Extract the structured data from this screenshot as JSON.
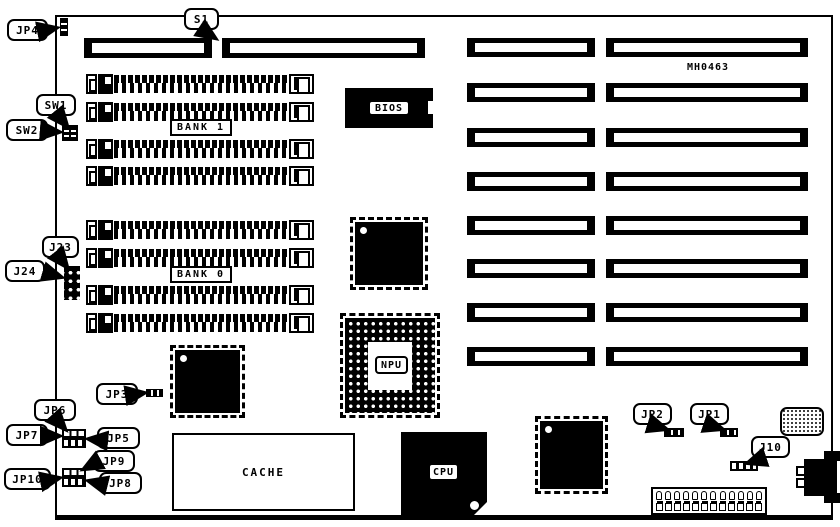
{
  "board": {
    "part_number": "MH0463"
  },
  "callouts": {
    "jp4": "JP4",
    "s1": "S1",
    "sw1": "SW1",
    "sw2": "SW2",
    "j23": "J23",
    "j24": "J24",
    "jp3": "JP3",
    "jp6": "JP6",
    "jp7": "JP7",
    "jp5": "JP5",
    "jp9": "JP9",
    "jp10": "JP10",
    "jp8": "JP8",
    "jp2": "JP2",
    "jp1": "JP1",
    "j10": "J10"
  },
  "chip_labels": {
    "bios": "BIOS",
    "npu": "NPU",
    "cpu": "CPU",
    "cache": "CACHE"
  },
  "bank_labels": {
    "bank1": "BANK 1",
    "bank0": "BANK 0"
  },
  "colors": {
    "line": "#000000",
    "bg": "#ffffff"
  }
}
